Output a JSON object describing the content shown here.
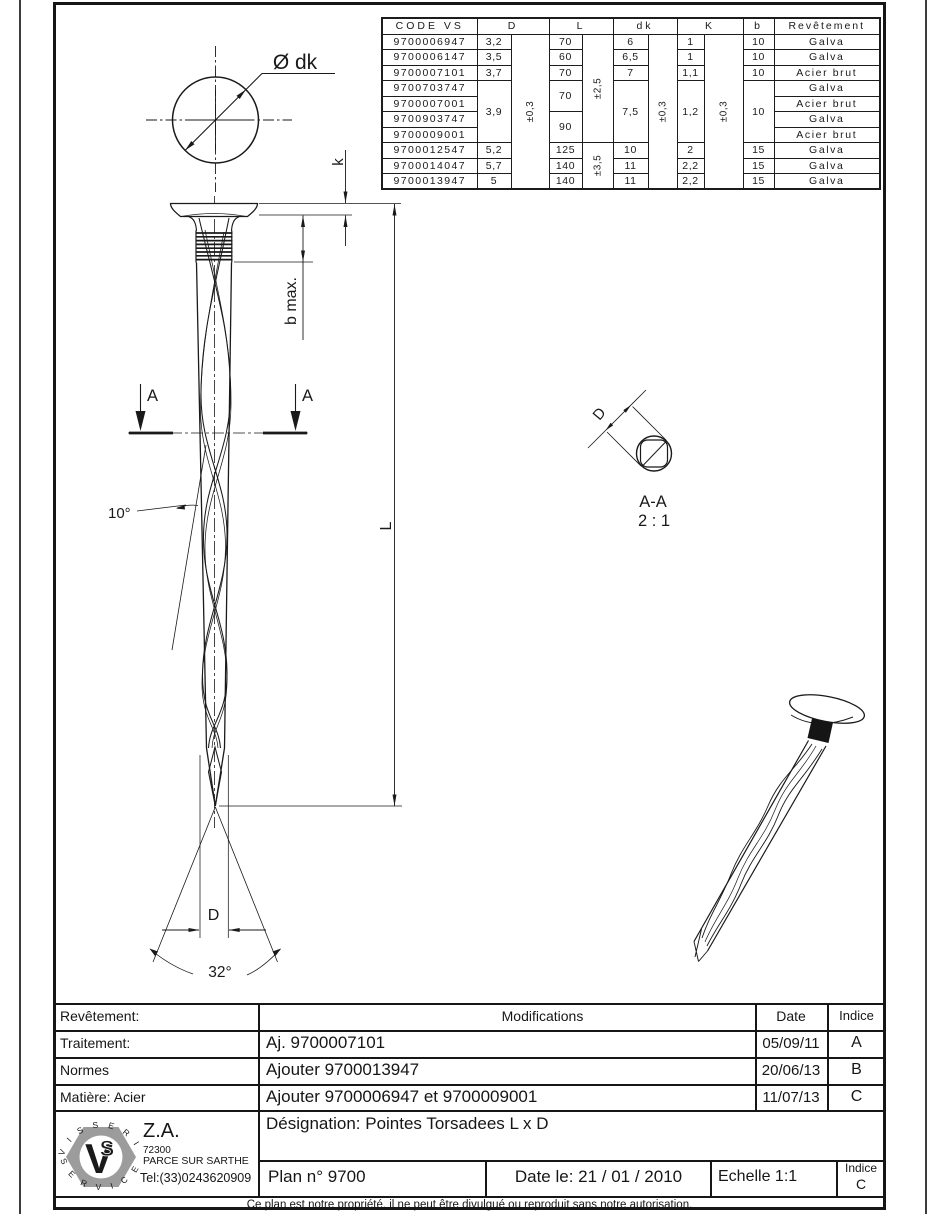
{
  "colors": {
    "line": "#1a1a1a",
    "logo_gray": "#9c9c9c"
  },
  "spec_table": {
    "headers": {
      "code": "CODE VS",
      "d": "D",
      "l": "L",
      "dk": "dk",
      "k": "K",
      "b": "b",
      "revetement": "Revêtement"
    },
    "tolerances": {
      "d": "±0,3",
      "l_upper": "±2,5",
      "l_lower": "±3,5",
      "dk": "±0,3",
      "k": "±0,3"
    },
    "rows": [
      {
        "code": "9700006947",
        "d": "3,2",
        "l": "70",
        "dk": "6",
        "k": "1",
        "b": "10",
        "rev": "Galva"
      },
      {
        "code": "9700006147",
        "d": "3,5",
        "l": "60",
        "dk": "6,5",
        "k": "1",
        "b": "10",
        "rev": "Galva"
      },
      {
        "code": "9700007101",
        "d": "3,7",
        "l": "70",
        "dk": "7",
        "k": "1,1",
        "b": "10",
        "rev": "Acier brut"
      },
      {
        "code": "9700703747",
        "d": "3,9",
        "l": "70",
        "dk": "7,5",
        "k": "1,2",
        "b": "10",
        "rev": "Galva"
      },
      {
        "code": "9700007001",
        "rev": "Acier brut"
      },
      {
        "code": "9700903747",
        "l": "90",
        "rev": "Galva"
      },
      {
        "code": "9700009001",
        "rev": "Acier brut"
      },
      {
        "code": "9700012547",
        "d": "5,2",
        "l": "125",
        "dk": "10",
        "k": "2",
        "b": "15",
        "rev": "Galva"
      },
      {
        "code": "9700014047",
        "d": "5,7",
        "l": "140",
        "dk": "11",
        "k": "2,2",
        "b": "15",
        "rev": "Galva"
      },
      {
        "code": "9700013947",
        "d": "5",
        "l": "140",
        "dk": "11",
        "k": "2,2",
        "b": "15",
        "rev": "Galva"
      }
    ]
  },
  "drawing": {
    "dk_label": "Ø dk",
    "k_label": "k",
    "bmax_label": "b max.",
    "l_label": "L",
    "cut_label": "A",
    "twist_angle": "10°",
    "tip_angle": "32°",
    "d_label": "D",
    "section_d_label": "D",
    "section_name": "A-A",
    "section_scale": "2 : 1"
  },
  "title_block": {
    "labels": {
      "revetement": "Revêtement:",
      "traitement": "Traitement:",
      "normes": "Normes",
      "matiere": "Matière: Acier"
    },
    "mod_header": "Modifications",
    "date_header": "Date",
    "indice_header": "Indice",
    "modifications": [
      {
        "text": "Aj. 9700007101",
        "date": "05/09/11",
        "indice": "A"
      },
      {
        "text": "Ajouter 9700013947",
        "date": "20/06/13",
        "indice": "B"
      },
      {
        "text": "Ajouter 9700006947 et 9700009001",
        "date": "11/07/13",
        "indice": "C"
      }
    ],
    "designation": "Désignation: Pointes Torsadees L x D",
    "plan": "Plan n° 9700",
    "date_le": "Date le: 21 / 01 / 2010",
    "echelle": "Echelle 1:1",
    "indice_label": "Indice",
    "indice_value": "C",
    "footer": "Ce plan est notre propriété, il ne peut être divulgué ou reproduit sans notre autorisation."
  },
  "company": {
    "ring_top": "V I S S E R I E",
    "ring_bottom": "S E R V I C E",
    "monogram_v": "V",
    "monogram_s": "S",
    "za": "Z.A.",
    "zip": "72300",
    "city": "PARCE SUR SARTHE",
    "tel": "Tel:(33)0243620909"
  }
}
